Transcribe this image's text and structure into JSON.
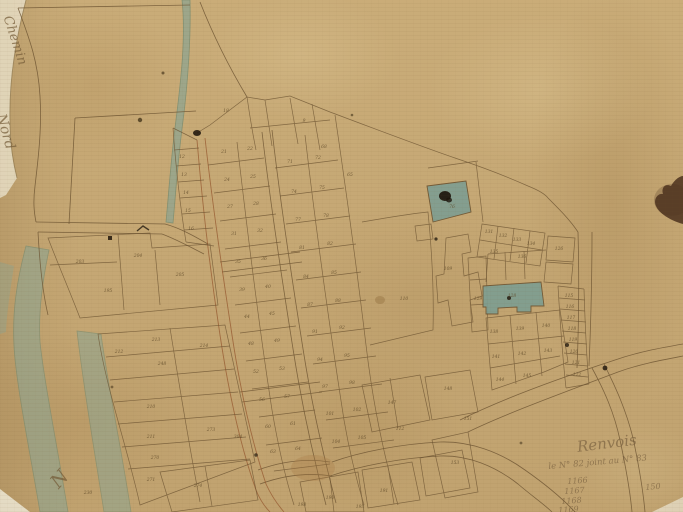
{
  "map": {
    "kind": "antique cadastral town plan, hand drawn ink on aged paper",
    "colors": {
      "paper": "#c9ab77",
      "ink": "#6b5230",
      "red_ink": "#96582f",
      "water": "#8fa591",
      "water_edge": "#6f8a72",
      "teal_parcel": "#7d9e92",
      "stain_dark": "#4e3420",
      "ink_text": "#5d4827"
    },
    "annotations": [
      {
        "text": "Chemin",
        "x": 14,
        "y": 14,
        "rot": 72,
        "size": 13,
        "cls": ""
      },
      {
        "text": "Nord",
        "x": 8,
        "y": 112,
        "rot": 74,
        "size": 14,
        "cls": ""
      },
      {
        "text": "N",
        "x": 46,
        "y": 478,
        "rot": -48,
        "size": 19,
        "cls": ""
      },
      {
        "text": "Renvois",
        "x": 576,
        "y": 438,
        "rot": -7,
        "size": 15,
        "cls": "note"
      },
      {
        "text": "le N° 82 joint au N° 83",
        "x": 548,
        "y": 462,
        "rot": -5,
        "size": 8.5,
        "cls": "note"
      },
      {
        "text": "1166",
        "x": 567,
        "y": 477,
        "rot": -4,
        "size": 8,
        "cls": "note"
      },
      {
        "text": "1167",
        "x": 564,
        "y": 487,
        "rot": -4,
        "size": 8,
        "cls": "note"
      },
      {
        "text": "1168",
        "x": 561,
        "y": 497,
        "rot": -4,
        "size": 8,
        "cls": "note"
      },
      {
        "text": "1169",
        "x": 558,
        "y": 506,
        "rot": -4,
        "size": 8,
        "cls": "note"
      },
      {
        "text": "150",
        "x": 645,
        "y": 483,
        "rot": -5,
        "size": 8,
        "cls": "note"
      }
    ],
    "parcel_labels": [
      {
        "t": "12",
        "x": 182,
        "y": 158
      },
      {
        "t": "13",
        "x": 184,
        "y": 176
      },
      {
        "t": "14",
        "x": 186,
        "y": 194
      },
      {
        "t": "15",
        "x": 188,
        "y": 212
      },
      {
        "t": "16",
        "x": 191,
        "y": 230
      },
      {
        "t": "18",
        "x": 226,
        "y": 112
      },
      {
        "t": "9",
        "x": 304,
        "y": 122
      },
      {
        "t": "68",
        "x": 324,
        "y": 148
      },
      {
        "t": "65",
        "x": 350,
        "y": 176
      },
      {
        "t": "203",
        "x": 80,
        "y": 263
      },
      {
        "t": "204",
        "x": 138,
        "y": 257
      },
      {
        "t": "195",
        "x": 108,
        "y": 292
      },
      {
        "t": "205",
        "x": 180,
        "y": 276
      },
      {
        "t": "213",
        "x": 156,
        "y": 341
      },
      {
        "t": "212",
        "x": 119,
        "y": 353
      },
      {
        "t": "248",
        "x": 162,
        "y": 365
      },
      {
        "t": "214",
        "x": 204,
        "y": 347
      },
      {
        "t": "210",
        "x": 151,
        "y": 408
      },
      {
        "t": "211",
        "x": 151,
        "y": 438
      },
      {
        "t": "270",
        "x": 155,
        "y": 459
      },
      {
        "t": "271",
        "x": 151,
        "y": 481
      },
      {
        "t": "230",
        "x": 88,
        "y": 494
      },
      {
        "t": "273",
        "x": 211,
        "y": 431
      },
      {
        "t": "274",
        "x": 198,
        "y": 487
      },
      {
        "t": "304",
        "x": 238,
        "y": 438
      },
      {
        "t": "21",
        "x": 224,
        "y": 153
      },
      {
        "t": "22",
        "x": 250,
        "y": 150
      },
      {
        "t": "24",
        "x": 227,
        "y": 181
      },
      {
        "t": "25",
        "x": 253,
        "y": 178
      },
      {
        "t": "27",
        "x": 230,
        "y": 208
      },
      {
        "t": "28",
        "x": 256,
        "y": 205
      },
      {
        "t": "31",
        "x": 234,
        "y": 235
      },
      {
        "t": "32",
        "x": 260,
        "y": 232
      },
      {
        "t": "35",
        "x": 238,
        "y": 263
      },
      {
        "t": "36",
        "x": 264,
        "y": 260
      },
      {
        "t": "39",
        "x": 242,
        "y": 291
      },
      {
        "t": "40",
        "x": 268,
        "y": 288
      },
      {
        "t": "44",
        "x": 247,
        "y": 318
      },
      {
        "t": "45",
        "x": 272,
        "y": 315
      },
      {
        "t": "48",
        "x": 251,
        "y": 345
      },
      {
        "t": "49",
        "x": 277,
        "y": 342
      },
      {
        "t": "52",
        "x": 256,
        "y": 373
      },
      {
        "t": "53",
        "x": 282,
        "y": 370
      },
      {
        "t": "56",
        "x": 262,
        "y": 401
      },
      {
        "t": "57",
        "x": 287,
        "y": 398
      },
      {
        "t": "60",
        "x": 268,
        "y": 428
      },
      {
        "t": "61",
        "x": 293,
        "y": 425
      },
      {
        "t": "63",
        "x": 273,
        "y": 453
      },
      {
        "t": "64",
        "x": 298,
        "y": 450
      },
      {
        "t": "71",
        "x": 290,
        "y": 163
      },
      {
        "t": "72",
        "x": 318,
        "y": 159
      },
      {
        "t": "74",
        "x": 294,
        "y": 193
      },
      {
        "t": "75",
        "x": 322,
        "y": 189
      },
      {
        "t": "77",
        "x": 298,
        "y": 221
      },
      {
        "t": "78",
        "x": 326,
        "y": 217
      },
      {
        "t": "81",
        "x": 302,
        "y": 249
      },
      {
        "t": "82",
        "x": 330,
        "y": 245
      },
      {
        "t": "84",
        "x": 306,
        "y": 278
      },
      {
        "t": "85",
        "x": 334,
        "y": 274
      },
      {
        "t": "87",
        "x": 310,
        "y": 306
      },
      {
        "t": "88",
        "x": 338,
        "y": 302
      },
      {
        "t": "91",
        "x": 315,
        "y": 333
      },
      {
        "t": "92",
        "x": 342,
        "y": 329
      },
      {
        "t": "94",
        "x": 320,
        "y": 361
      },
      {
        "t": "95",
        "x": 347,
        "y": 357
      },
      {
        "t": "97",
        "x": 325,
        "y": 388
      },
      {
        "t": "98",
        "x": 352,
        "y": 384
      },
      {
        "t": "101",
        "x": 330,
        "y": 415
      },
      {
        "t": "102",
        "x": 357,
        "y": 411
      },
      {
        "t": "104",
        "x": 336,
        "y": 443
      },
      {
        "t": "105",
        "x": 362,
        "y": 439
      },
      {
        "t": "109",
        "x": 448,
        "y": 270
      },
      {
        "t": "110",
        "x": 404,
        "y": 300
      },
      {
        "t": "76",
        "x": 452,
        "y": 208
      },
      {
        "t": "128",
        "x": 512,
        "y": 297
      },
      {
        "t": "131",
        "x": 489,
        "y": 233
      },
      {
        "t": "132",
        "x": 503,
        "y": 237
      },
      {
        "t": "133",
        "x": 517,
        "y": 241
      },
      {
        "t": "134",
        "x": 531,
        "y": 245
      },
      {
        "t": "135",
        "x": 494,
        "y": 253
      },
      {
        "t": "136",
        "x": 522,
        "y": 258
      },
      {
        "t": "126",
        "x": 559,
        "y": 250
      },
      {
        "t": "129",
        "x": 478,
        "y": 300
      },
      {
        "t": "138",
        "x": 494,
        "y": 333
      },
      {
        "t": "139",
        "x": 520,
        "y": 330
      },
      {
        "t": "140",
        "x": 546,
        "y": 327
      },
      {
        "t": "141",
        "x": 496,
        "y": 358
      },
      {
        "t": "142",
        "x": 522,
        "y": 355
      },
      {
        "t": "143",
        "x": 548,
        "y": 352
      },
      {
        "t": "144",
        "x": 500,
        "y": 381
      },
      {
        "t": "145",
        "x": 527,
        "y": 377
      },
      {
        "t": "115",
        "x": 569,
        "y": 297
      },
      {
        "t": "116",
        "x": 570,
        "y": 308
      },
      {
        "t": "117",
        "x": 571,
        "y": 319
      },
      {
        "t": "118",
        "x": 572,
        "y": 330
      },
      {
        "t": "119",
        "x": 573,
        "y": 341
      },
      {
        "t": "120",
        "x": 574,
        "y": 353
      },
      {
        "t": "121",
        "x": 576,
        "y": 364
      },
      {
        "t": "122",
        "x": 577,
        "y": 376
      },
      {
        "t": "147",
        "x": 392,
        "y": 404
      },
      {
        "t": "148",
        "x": 448,
        "y": 390
      },
      {
        "t": "112",
        "x": 400,
        "y": 430
      },
      {
        "t": "151",
        "x": 468,
        "y": 420
      },
      {
        "t": "153",
        "x": 455,
        "y": 464
      },
      {
        "t": "190",
        "x": 330,
        "y": 499
      },
      {
        "t": "191",
        "x": 384,
        "y": 492
      },
      {
        "t": "198",
        "x": 302,
        "y": 506
      },
      {
        "t": "193",
        "x": 360,
        "y": 508
      }
    ]
  }
}
